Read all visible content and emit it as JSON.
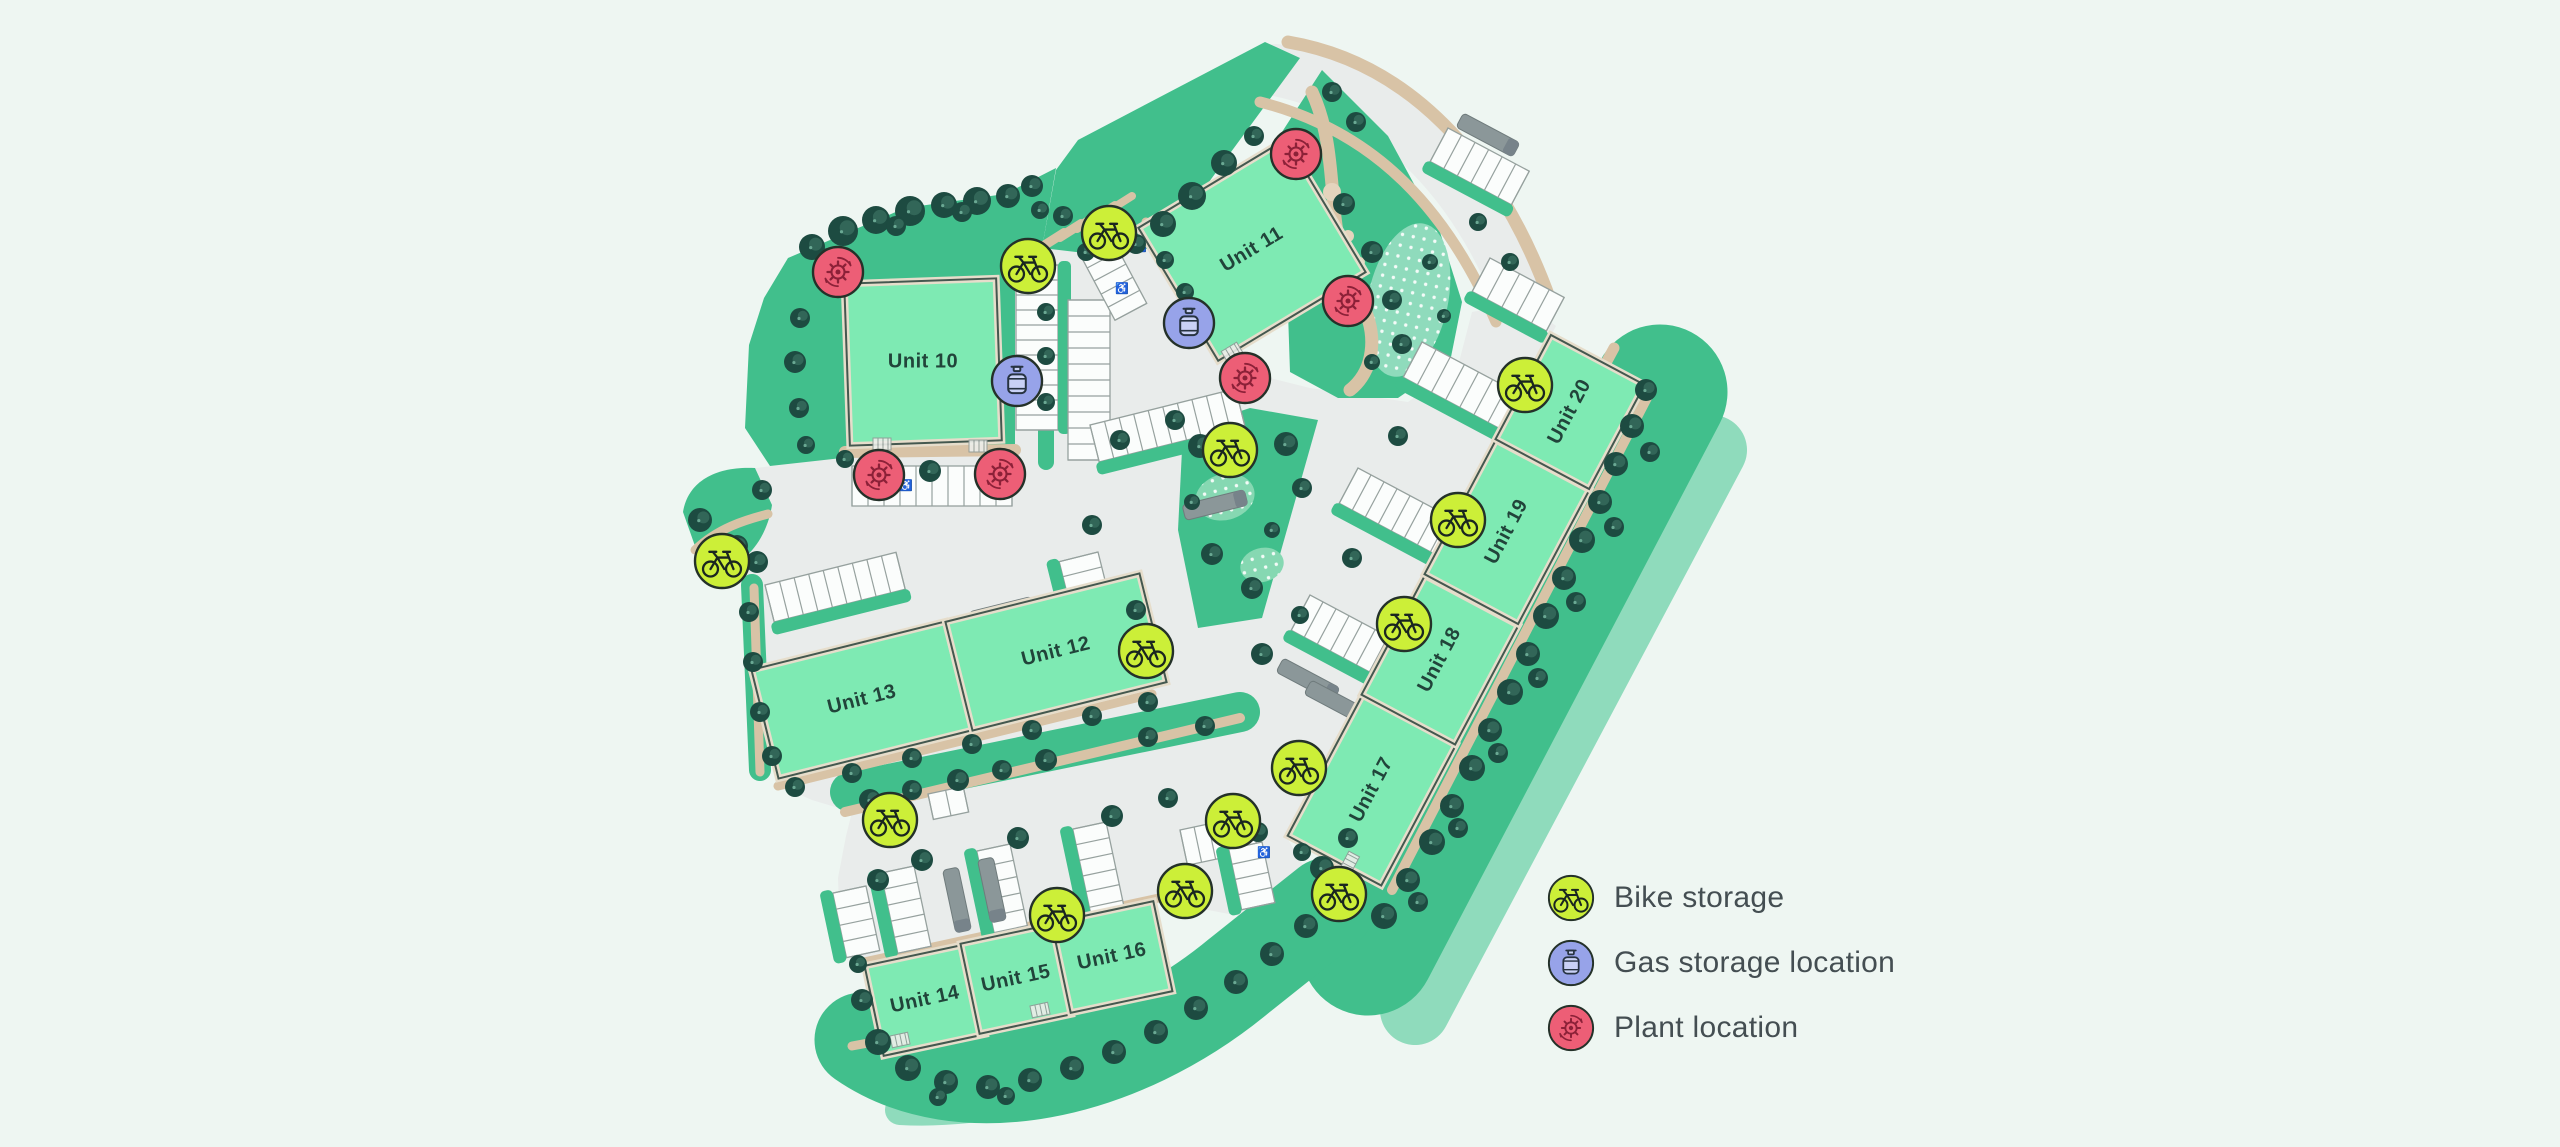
{
  "page": {
    "background": "#eef6f2"
  },
  "legend": {
    "items": [
      {
        "id": "bike",
        "label": "Bike storage",
        "icon": "bike-icon",
        "color": "#ccef38"
      },
      {
        "id": "gas",
        "label": "Gas storage location",
        "icon": "gas-cylinder-icon",
        "color": "#97a3e9"
      },
      {
        "id": "plant",
        "label": "Plant location",
        "icon": "plant-gear-icon",
        "color": "#ed5e76"
      }
    ]
  },
  "map": {
    "units": [
      {
        "id": "unit-10",
        "label": "Unit 10",
        "cx": 923,
        "cy": 362,
        "w": 152,
        "h": 162,
        "rot": -2,
        "labelRot": 0
      },
      {
        "id": "unit-11",
        "label": "Unit 11",
        "cx": 1252,
        "cy": 250,
        "w": 172,
        "h": 155,
        "rot": -31,
        "labelRot": -31
      },
      {
        "id": "unit-13",
        "label": "Unit 13",
        "cx": 862,
        "cy": 700,
        "w": 200,
        "h": 112,
        "rot": -14,
        "labelRot": -14
      },
      {
        "id": "unit-12",
        "label": "Unit 12",
        "cx": 1056,
        "cy": 652,
        "w": 200,
        "h": 112,
        "rot": -14,
        "labelRot": -14
      },
      {
        "id": "unit-14",
        "label": "Unit 14",
        "cx": 925,
        "cy": 1000,
        "w": 104,
        "h": 92,
        "rot": -12,
        "labelRot": -12
      },
      {
        "id": "unit-15",
        "label": "Unit 15",
        "cx": 1016,
        "cy": 979,
        "w": 94,
        "h": 92,
        "rot": -12,
        "labelRot": -12
      },
      {
        "id": "unit-16",
        "label": "Unit 16",
        "cx": 1112,
        "cy": 957,
        "w": 104,
        "h": 92,
        "rot": -12,
        "labelRot": -12
      },
      {
        "id": "unit-17",
        "label": "Unit 17",
        "cx": 1372,
        "cy": 790,
        "w": 160,
        "h": 106,
        "rot": -62,
        "labelRot": -62
      },
      {
        "id": "unit-18",
        "label": "Unit 18",
        "cx": 1440,
        "cy": 660,
        "w": 135,
        "h": 106,
        "rot": -62,
        "labelRot": -62
      },
      {
        "id": "unit-19",
        "label": "Unit 19",
        "cx": 1507,
        "cy": 532,
        "w": 152,
        "h": 106,
        "rot": -62,
        "labelRot": -62
      },
      {
        "id": "unit-20",
        "label": "Unit 20",
        "cx": 1570,
        "cy": 412,
        "w": 118,
        "h": 106,
        "rot": -62,
        "labelRot": -62
      }
    ],
    "markers": {
      "bike": [
        [
          1109,
          233
        ],
        [
          1028,
          266
        ],
        [
          1230,
          450
        ],
        [
          722,
          561
        ],
        [
          1146,
          651
        ],
        [
          1404,
          624
        ],
        [
          1525,
          385
        ],
        [
          1458,
          520
        ],
        [
          1299,
          768
        ],
        [
          1233,
          821
        ],
        [
          1185,
          891
        ],
        [
          1339,
          894
        ],
        [
          890,
          820
        ],
        [
          1057,
          915
        ]
      ],
      "gas": [
        [
          1017,
          381
        ],
        [
          1189,
          323
        ]
      ],
      "plant": [
        [
          838,
          272
        ],
        [
          1296,
          154
        ],
        [
          1348,
          301
        ],
        [
          1245,
          378
        ],
        [
          879,
          475
        ],
        [
          1000,
          474
        ]
      ]
    }
  },
  "colors": {
    "building": "#7eeab3",
    "building_edge": "#e6ddcb",
    "building_outline": "#44584f",
    "grass": "#41bf8c",
    "grass_light": "#8fdbbc",
    "tree_dark": "#1d4b41",
    "tree_mid": "#437e6b",
    "tree_speck": "#6aa893",
    "road": "#e9eceb",
    "path": "#d8c3a6",
    "path_light": "#e4d4bd",
    "stall_fill": "#fbfdfc",
    "stall_outline": "#96a19e",
    "truck": "#8b9799",
    "label_text": "#21443a",
    "legend_text": "#444e52",
    "bike_fill": "#ccef38",
    "bike_glyph": "#1a2620",
    "gas_fill": "#97a3e9",
    "gas_glyph": "#273341",
    "plant_fill": "#ed5e76",
    "plant_glyph": "#8c2138",
    "marker_outline": "#243129"
  }
}
